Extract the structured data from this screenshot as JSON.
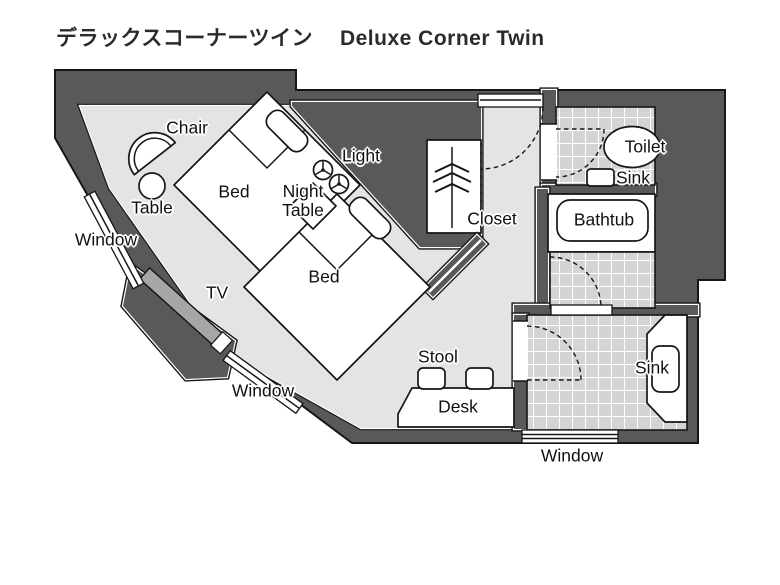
{
  "title": {
    "ja": "デラックスコーナーツイン",
    "en": "Deluxe Corner Twin"
  },
  "labels": {
    "chair": "Chair",
    "table": "Table",
    "window": "Window",
    "bed": "Bed",
    "night_table": "Night\nTable",
    "light": "Light",
    "tv": "TV",
    "stool": "Stool",
    "desk": "Desk",
    "closet": "Closet",
    "toilet": "Toilet",
    "sink": "Sink",
    "bathtub": "Bathtub"
  },
  "colors": {
    "wall": "#595959",
    "floor": "#e4e4e4",
    "tile": "#d4d4d4",
    "tv": "#a6a6a6",
    "fixture": "#ffffff",
    "line": "#161616"
  }
}
